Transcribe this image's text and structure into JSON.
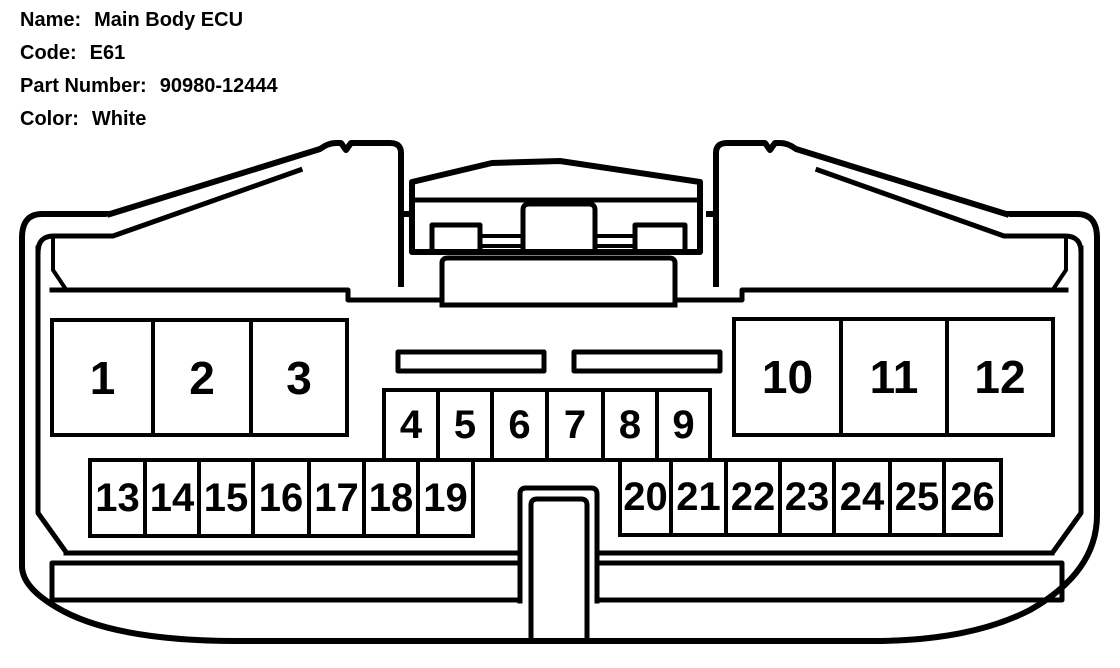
{
  "header": {
    "fields": [
      {
        "label": "Name:",
        "value": "Main Body ECU"
      },
      {
        "label": "Code:",
        "value": "E61"
      },
      {
        "label": "Part Number:",
        "value": "90980-12444"
      },
      {
        "label": "Color:",
        "value": "White"
      }
    ]
  },
  "connector": {
    "description": "26-pin connector housing face view (line drawing)",
    "line_color": "#000000",
    "background_color": "#ffffff",
    "pin_count": 26,
    "pin_groups": [
      {
        "name": "row-a-left",
        "pins": [
          "1",
          "2",
          "3"
        ]
      },
      {
        "name": "row-b-center",
        "pins": [
          "4",
          "5",
          "6",
          "7",
          "8",
          "9"
        ]
      },
      {
        "name": "row-a-right",
        "pins": [
          "10",
          "11",
          "12"
        ]
      },
      {
        "name": "row-c-left",
        "pins": [
          "13",
          "14",
          "15",
          "16",
          "17",
          "18",
          "19"
        ]
      },
      {
        "name": "row-c-right",
        "pins": [
          "20",
          "21",
          "22",
          "23",
          "24",
          "25",
          "26"
        ]
      }
    ]
  }
}
